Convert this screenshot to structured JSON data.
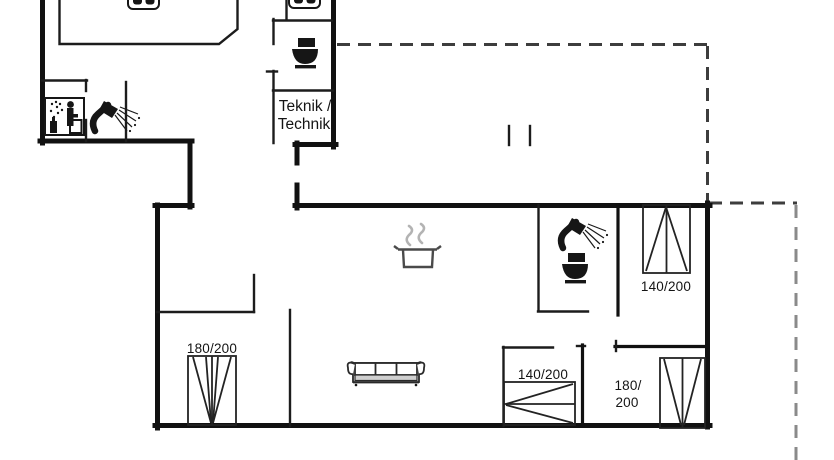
{
  "floorplan": {
    "title": "holiday-house floor plan",
    "labels": {
      "teknik_line1": "Teknik /",
      "teknik_line2": "Technik",
      "bed_top_right": "140/200",
      "bed_bottom_left": "180/200",
      "bed_bottom_middle": "140/200",
      "bed_bottom_right_line1": "180/",
      "bed_bottom_right_line2": "200"
    },
    "icons": {
      "toilet_top": "toilet-icon",
      "toilet_bath": "toilet-icon",
      "shower_sauna_room": "shower-icon",
      "shower_bath": "shower-icon",
      "sauna": "sauna-icon",
      "sink_island": "double-sink-icon",
      "sink_wc": "double-sink-icon",
      "stove_pot": "cooking-pot-icon",
      "sofa": "sofa-icon",
      "beds": "bed-icon"
    },
    "colors": {
      "wall": "#111111",
      "interior_wall": "#1c1c1c",
      "dashed_overhang": "#3d3d3d",
      "dashed_overhang_right": "#8a8a8a",
      "steam": "#b3b3b3",
      "sofa_band": "#cfcfcf",
      "background": "#ffffff",
      "text": "#141414"
    }
  }
}
